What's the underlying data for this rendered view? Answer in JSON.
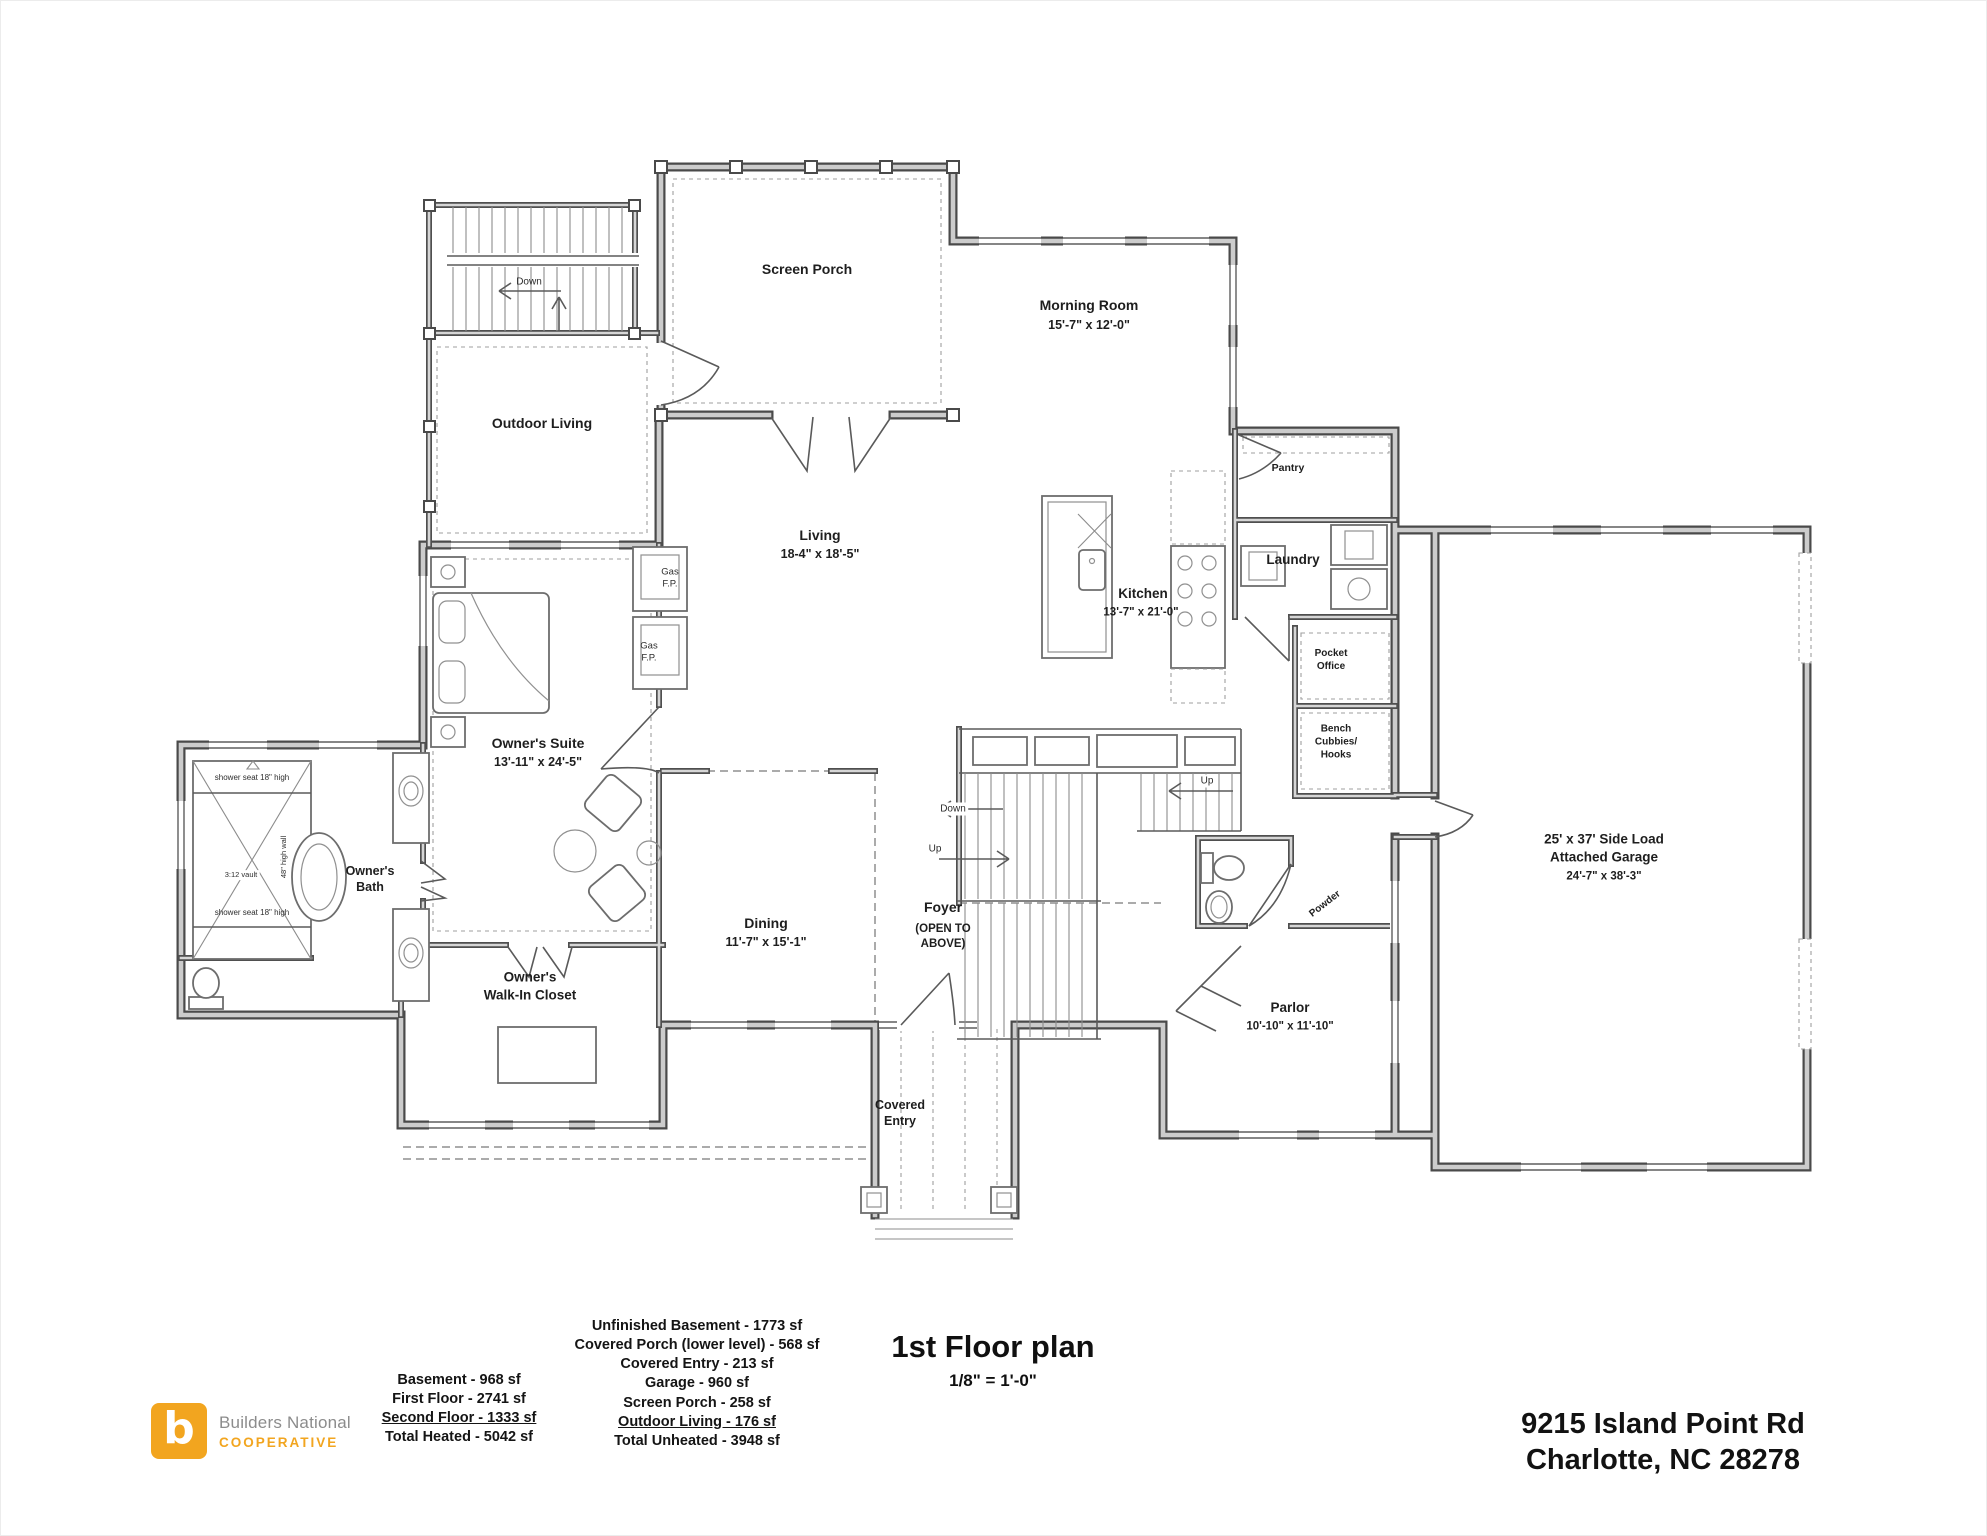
{
  "sheet": {
    "background": "#ffffff",
    "ink": "#4a4a4a"
  },
  "title_block": {
    "title": "1st Floor plan",
    "scale": "1/8\" = 1'-0\"",
    "address_line1": "9215 Island Point Rd",
    "address_line2": "Charlotte, NC 28278"
  },
  "logo": {
    "mark": "b",
    "line1": "Builders National",
    "line2": "COOPERATIVE",
    "orange": "#F2A51F",
    "gray": "#8c8c8c"
  },
  "areas": {
    "heated": [
      "Basement - 968 sf",
      "First Floor - 2741 sf",
      "Second Floor - 1333 sf",
      "Total Heated - 5042 sf"
    ],
    "unheated": [
      "Unfinished Basement - 1773 sf",
      "Covered Porch (lower level) - 568 sf",
      "Covered Entry - 213 sf",
      "Garage - 960 sf",
      "Screen Porch - 258 sf",
      "Outdoor Living - 176 sf",
      "Total Unheated - 3948 sf"
    ]
  },
  "rooms": {
    "screen_porch": {
      "name": "Screen Porch"
    },
    "morning_room": {
      "name": "Morning Room",
      "dims": "15'-7\" x 12'-0\""
    },
    "outdoor_living": {
      "name": "Outdoor Living"
    },
    "living": {
      "name": "Living",
      "dims": "18-4\" x 18'-5\""
    },
    "kitchen": {
      "name": "Kitchen",
      "dims": "13'-7\" x 21'-0\""
    },
    "pantry": {
      "name": "Pantry"
    },
    "laundry": {
      "name": "Laundry"
    },
    "pocket_office": {
      "name": "Pocket\nOffice"
    },
    "bench": {
      "name": "Bench\nCubbies/\nHooks"
    },
    "garage": {
      "name": "25' x 37' Side Load\nAttached Garage",
      "dims": "24'-7\" x 38'-3\""
    },
    "owners_suite": {
      "name": "Owner's Suite",
      "dims": "13'-11\" x 24'-5\""
    },
    "owners_bath": {
      "name": "Owner's\nBath"
    },
    "owners_closet": {
      "name": "Owner's\nWalk-In Closet"
    },
    "dining": {
      "name": "Dining",
      "dims": "11'-7\" x 15'-1\""
    },
    "foyer": {
      "name": "Foyer",
      "note": "(OPEN TO\nABOVE)"
    },
    "parlor": {
      "name": "Parlor",
      "dims": "10'-10\" x 11'-10\""
    },
    "covered_entry": {
      "name": "Covered\nEntry"
    },
    "powder": {
      "name": "Powder"
    }
  },
  "annotations": {
    "gas_fireplace": "Gas\nF.P.",
    "stairs_down": "Down",
    "stairs_up": "Up",
    "shower_seat": "shower seat 18\" high",
    "vault": "3:12 vault",
    "high_wall": "48\" high wall"
  }
}
